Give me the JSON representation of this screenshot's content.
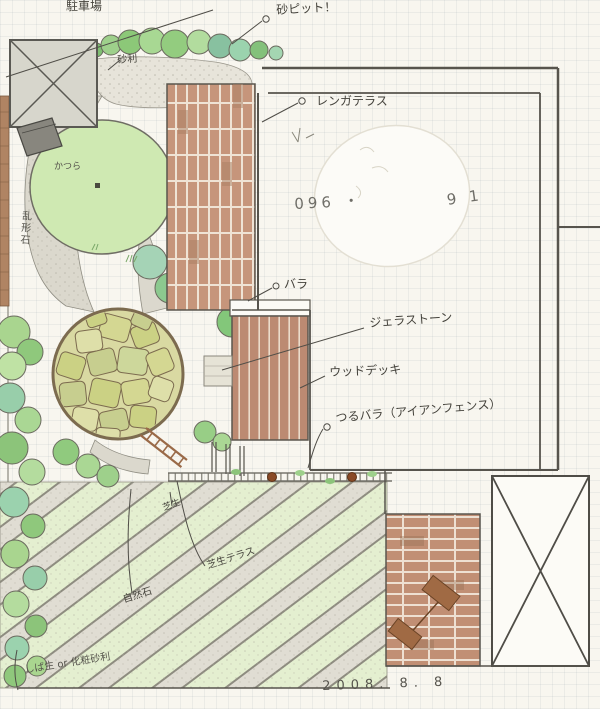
{
  "labels": {
    "parking": "駐車場",
    "sand_pit": "砂ピット！",
    "gravel": "砂利",
    "brick_terrace": "レンガテラス",
    "rose": "バラ",
    "gela_stone": "ジェラストーン",
    "wood_deck": "ウッドデッキ",
    "climbing_rose": "つるバラ（アイアンフェンス）",
    "katsura_tree": "かつら",
    "crazy_paving_path": "乱形石",
    "lawn": "芝生",
    "natural_stone": "自然石",
    "lawn_terrace": "芝生テラス",
    "bottom_note": "しば生 or 化粧砂利",
    "phone_partial_left": "096 ・",
    "phone_partial_right": "9 1",
    "date": "2008.  8.  8"
  },
  "colors": {
    "paper": "#f8f6ef",
    "canopy_green": "#cfe9b2",
    "shrub_green": "#8cc47a",
    "lawn_stripe": "#e4efd0",
    "stone_stripe": "#e0ddd3",
    "brick": "#c6957b",
    "deck_wood": "#bc8a72",
    "stone_circle": "#d4d792",
    "path_gray": "#dbd8cd",
    "ink": "#57544d"
  }
}
